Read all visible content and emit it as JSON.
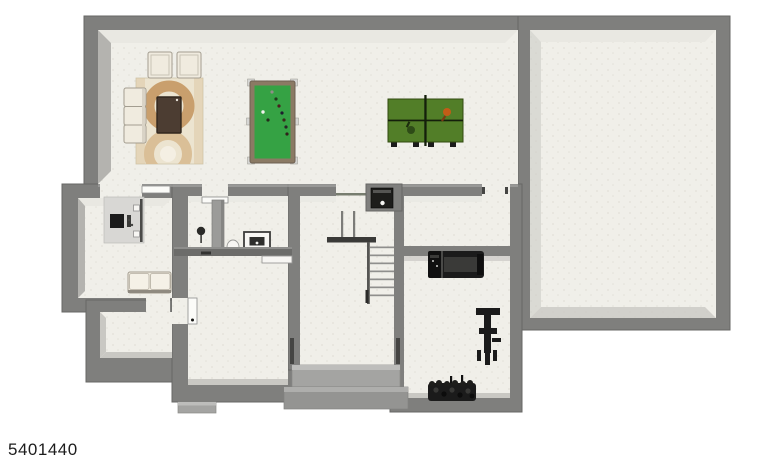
{
  "watermark": {
    "listing_id": "5401440"
  },
  "colors": {
    "background": "#ffffff",
    "wall": "#7f7f7d",
    "wall_edge": "#676765",
    "wall_top": "#a8a8a6",
    "floor": "#f0efe9",
    "floor_speck": "#e3e1d8",
    "face_light": "#e9e8e2",
    "face_mid": "#b4b3af",
    "face_soft": "#c9c8c3",
    "step_light": "#a4a4a2",
    "step_dark": "#949492",
    "door_leaf": "#fbfbf8",
    "pool_felt": "#35a244",
    "pool_rail": "#8b7a64",
    "pocket": "#d6d6d4",
    "pingpong": "#527e28",
    "pingpong_line": "#141f0b",
    "paddle_orange": "#c25c17",
    "paddle_dark": "#2e4b17",
    "rug_base": "#ece4d0",
    "rug_ring_dark": "#c99f6d",
    "rug_ring_light": "#dabf97",
    "rug_center": "#f4efe3",
    "upholstery": "#f0ebdf",
    "upholstery_edge": "#a39d90",
    "wood": "#4c3d32",
    "equipment": "#1b1b1b",
    "equipment_mid": "#3a3a38",
    "desk": "#d8d7d4",
    "cabinet": "#9b9b99",
    "counter": "#6c6c6a",
    "stair_tread": "#8f8f8d",
    "stair_rail": "#555553",
    "label": "#1c1c1c"
  },
  "floorplan": {
    "type": "residential-basement-floor-plan",
    "rooms": [
      {
        "id": "recreation-room",
        "items": [
          "sofa",
          "ottoman",
          "ottoman",
          "area-rug",
          "coffee-table",
          "pool-table",
          "ping-pong-table"
        ]
      },
      {
        "id": "den",
        "items": [
          "desk",
          "tv",
          "loveseat"
        ]
      },
      {
        "id": "closet",
        "items": []
      },
      {
        "id": "utility-room",
        "items": [
          "floor-lamp",
          "storage-cabinet",
          "utility-sink",
          "laundry-tub",
          "counter"
        ]
      },
      {
        "id": "stair-hall",
        "items": [
          "staircase",
          "furnace",
          "entry-steps",
          "door"
        ]
      },
      {
        "id": "storage-room",
        "items": []
      },
      {
        "id": "exercise-room",
        "items": [
          "treadmill",
          "weight-bench",
          "dumbbell-rack"
        ]
      },
      {
        "id": "unfinished-room",
        "items": []
      }
    ]
  }
}
